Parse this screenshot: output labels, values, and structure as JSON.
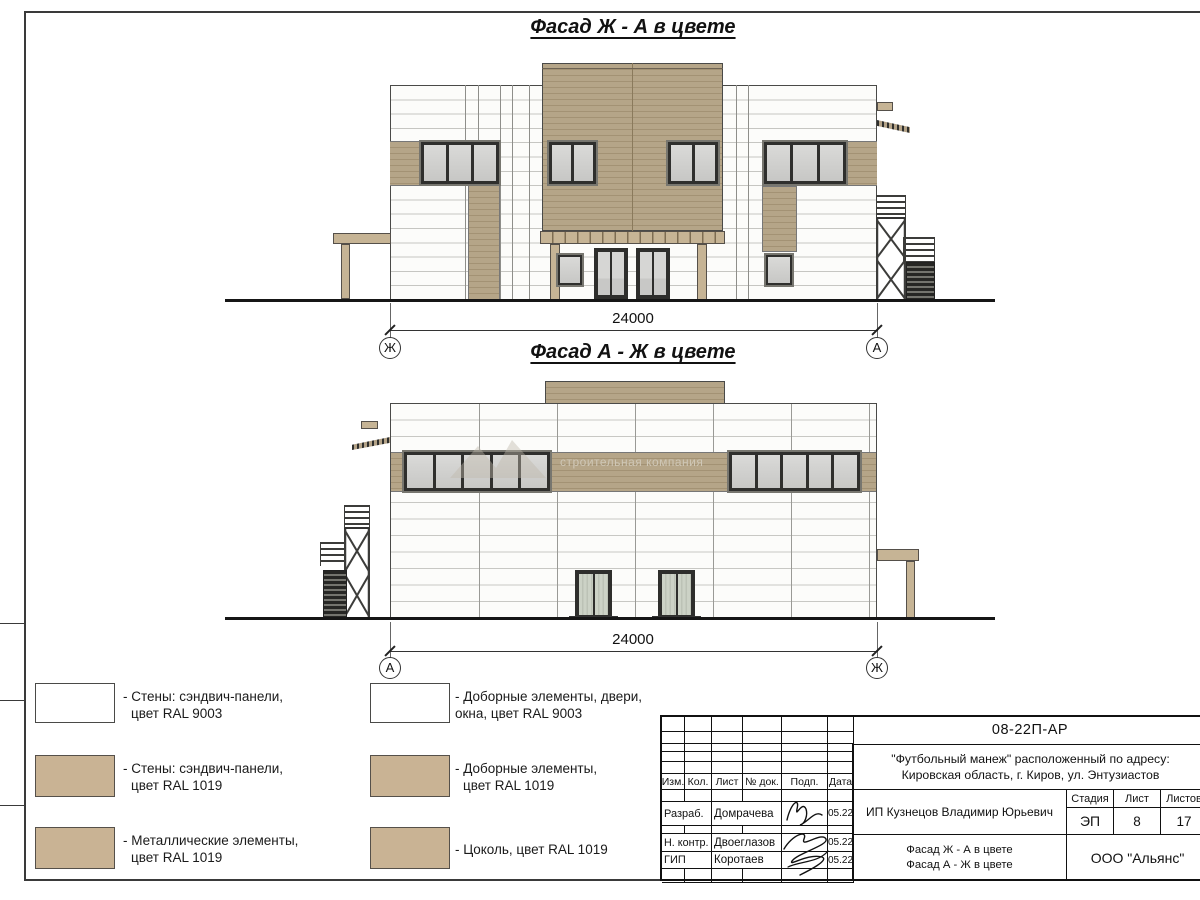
{
  "sheet": {
    "facade1_title": "Фасад Ж - А в цвете",
    "facade2_title": "Фасад А - Ж в цвете",
    "watermark_text": "строительная компания"
  },
  "dimensions": {
    "facade1": {
      "value": "24000",
      "left_marker": "Ж",
      "right_marker": "А"
    },
    "facade2": {
      "value": "24000",
      "left_marker": "А",
      "right_marker": "Ж"
    }
  },
  "legend": {
    "items": [
      {
        "swatch_color": "#ffffff",
        "line1": "- Стены: сэндвич-панели,",
        "line2": "цвет RAL 9003"
      },
      {
        "swatch_color": "#c9b394",
        "line1": "- Стены: сэндвич-панели,",
        "line2": "цвет RAL 1019"
      },
      {
        "swatch_color": "#c9b394",
        "line1": "- Металлические элементы,",
        "line2": "цвет RAL 1019"
      },
      {
        "swatch_color": "#ffffff",
        "line1": "- Доборные элементы, двери,",
        "line2": "окна, цвет RAL 9003"
      },
      {
        "swatch_color": "#c9b394",
        "line1": "- Доборные элементы,",
        "line2": "цвет RAL 1019"
      },
      {
        "swatch_color": "#c9b394",
        "line1": "- Цоколь, цвет RAL 1019",
        "line2": ""
      }
    ]
  },
  "titleblock": {
    "doc_number": "08-22П-АР",
    "project_line1": "\"Футбольный манеж\" расположенный по адресу:",
    "project_line2": "Кировская область, г. Киров, ул. Энтузиастов",
    "client": "ИП Кузнецов Владимир Юрьевич",
    "headers": {
      "izm": "Изм.",
      "kol": "Кол.",
      "list": "Лист",
      "doc": "№ док.",
      "podp": "Подп.",
      "data": "Дата"
    },
    "roles": {
      "razrab": "Разраб.",
      "nkontr": "Н. контр.",
      "gip": "ГИП"
    },
    "names": {
      "razrab": "Домрачева",
      "nkontr": "Двоеглазов",
      "gip": "Коротаев"
    },
    "dates": {
      "razrab": "05.22",
      "nkontr": "05.22",
      "gip": "05.22"
    },
    "stage_label": "Стадия",
    "stage_value": "ЭП",
    "sheet_label": "Лист",
    "sheet_value": "8",
    "sheets_label": "Листов",
    "sheets_value": "17",
    "sheet_title_line1": "Фасад Ж - А в цвете",
    "sheet_title_line2": "Фасад А - Ж в цвете",
    "company": "ООО \"Альянс\""
  },
  "colors": {
    "ral9003": "#ffffff",
    "ral1019_swatch": "#c9b394",
    "panel_tan": "#b2a287",
    "line_dark": "#1c1c1c"
  }
}
